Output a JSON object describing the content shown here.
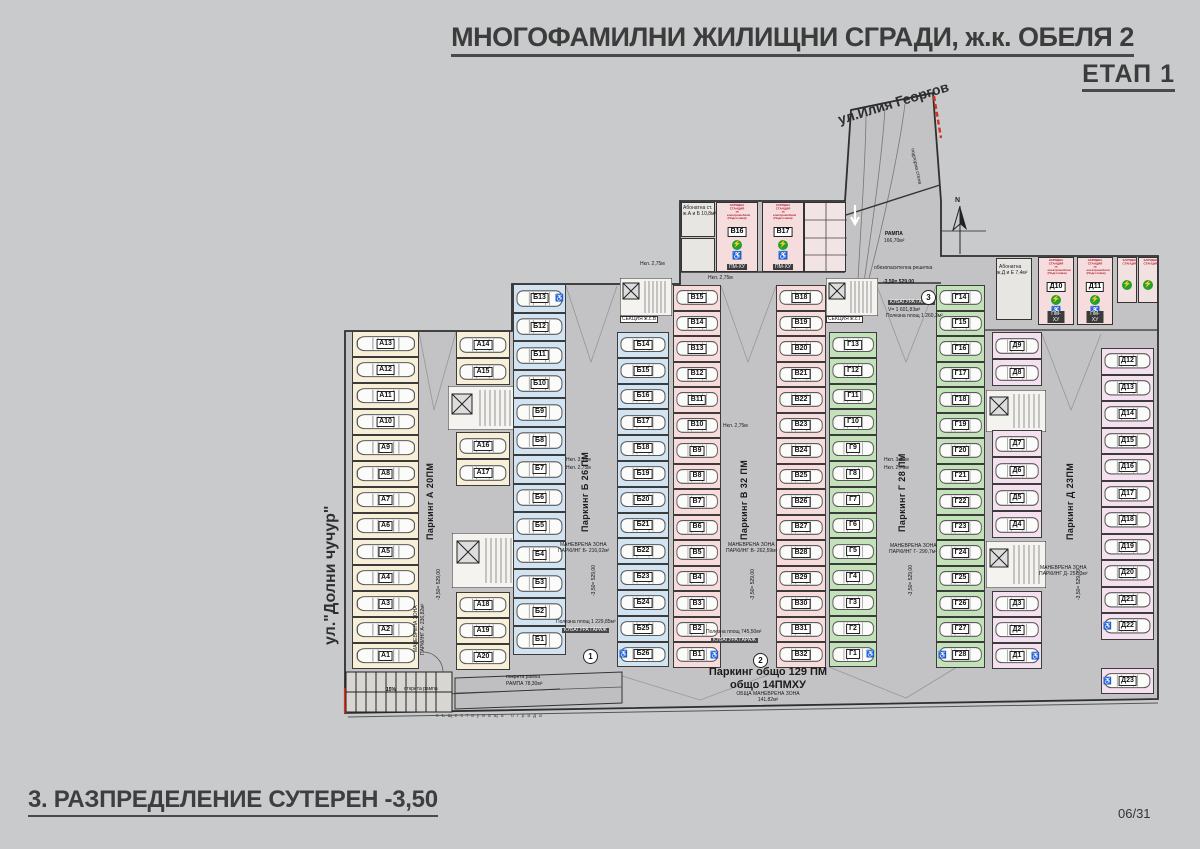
{
  "header": {
    "title": "МНОГОФАМИЛНИ ЖИЛИЩНИ СГРАДИ, ж.к. ОБЕЛЯ 2",
    "stage": "ЕТАП 1"
  },
  "footer": {
    "drawing_title": "3. РАЗПРЕДЕЛЕНИЕ СУТЕРЕН -3,50",
    "sheet": "06/31"
  },
  "streets": {
    "left": "ул.\"Долни чучур\"",
    "top_right": "ул.Илия Георгов"
  },
  "plan": {
    "north": "N",
    "totals": {
      "l1": "Паркинг общо 129 ПМ",
      "l2": "общо 14ПМХУ",
      "l3": "ОБЩА МАНЕВРЕНА ЗОНА",
      "l4": "141,82м²"
    },
    "sections": [
      {
        "id": "А",
        "color": "#f7efd8"
      },
      {
        "id": "Б",
        "color": "#d2e3f1"
      },
      {
        "id": "В",
        "color": "#f8dcdc"
      },
      {
        "id": "Г",
        "color": "#c4e2ba"
      },
      {
        "id": "Д",
        "color": "#f4e0ee"
      }
    ],
    "accessible": [
      "Б13",
      "Б26",
      "В1",
      "Г1",
      "Г28",
      "Д1",
      "Д22",
      "Д23"
    ],
    "columns": [
      {
        "sec": 0,
        "side": "L",
        "x": 352,
        "y": 331,
        "w": 67,
        "h": 26,
        "ids": [
          "А13",
          "А12",
          "А11",
          "А10",
          "А9",
          "А8",
          "А7",
          "А6",
          "А5",
          "А4",
          "А3",
          "А2",
          "А1"
        ]
      },
      {
        "sec": 0,
        "side": "L",
        "x": 456,
        "y": 331,
        "w": 54,
        "h": 27,
        "ids": [
          "А14",
          "А15"
        ]
      },
      {
        "sec": 0,
        "side": "L",
        "x": 456,
        "y": 432,
        "w": 54,
        "h": 27,
        "ids": [
          "А16",
          "А17"
        ]
      },
      {
        "sec": 0,
        "side": "L",
        "x": 456,
        "y": 592,
        "w": 54,
        "h": 26,
        "ids": [
          "А18",
          "А19",
          "А20"
        ]
      },
      {
        "sec": 1,
        "side": "L",
        "x": 513,
        "y": 284,
        "w": 53,
        "h": 28.5,
        "ids": [
          "Б13",
          "Б12",
          "Б11",
          "Б10",
          "Б9",
          "Б8",
          "Б7",
          "Б6",
          "Б5",
          "Б4",
          "Б3",
          "Б2",
          "Б1"
        ]
      },
      {
        "sec": 1,
        "side": "R",
        "x": 617,
        "y": 332,
        "w": 52,
        "h": 25.8,
        "ids": [
          "Б14",
          "Б15",
          "Б16",
          "Б17",
          "Б18",
          "Б19",
          "Б20",
          "Б21",
          "Б22",
          "Б23",
          "Б24",
          "Б25",
          "Б26"
        ]
      },
      {
        "sec": 2,
        "side": "L",
        "x": 673,
        "y": 285,
        "w": 48,
        "h": 25.5,
        "ids": [
          "В15",
          "В14",
          "В13",
          "В12",
          "В11",
          "В10",
          "В9",
          "В8",
          "В7",
          "В6",
          "В5",
          "В4",
          "В3",
          "В2",
          "В1"
        ]
      },
      {
        "sec": 2,
        "side": "R",
        "x": 776,
        "y": 285,
        "w": 50,
        "h": 25.5,
        "ids": [
          "В18",
          "В19",
          "В20",
          "В21",
          "В22",
          "В23",
          "В24",
          "В25",
          "В26",
          "В27",
          "В28",
          "В29",
          "В30",
          "В31",
          "В32"
        ]
      },
      {
        "sec": 3,
        "side": "L",
        "x": 829,
        "y": 332,
        "w": 48,
        "h": 25.8,
        "ids": [
          "Г13",
          "Г12",
          "Г11",
          "Г10",
          "Г9",
          "Г8",
          "Г7",
          "Г6",
          "Г5",
          "Г4",
          "Г3",
          "Г2",
          "Г1"
        ]
      },
      {
        "sec": 3,
        "side": "R",
        "x": 936,
        "y": 285,
        "w": 49,
        "h": 25.5,
        "ids": [
          "Г14",
          "Г15",
          "Г16",
          "Г17",
          "Г18",
          "Г19",
          "Г20",
          "Г21",
          "Г22",
          "Г23",
          "Г24",
          "Г25",
          "Г26",
          "Г27",
          "Г28"
        ]
      },
      {
        "sec": 4,
        "side": "L",
        "x": 992,
        "y": 332,
        "w": 50,
        "h": 27,
        "ids": [
          "Д9",
          "Д8"
        ]
      },
      {
        "sec": 4,
        "side": "L",
        "x": 992,
        "y": 430,
        "w": 50,
        "h": 27,
        "ids": [
          "Д7",
          "Д6",
          "Д5",
          "Д4"
        ]
      },
      {
        "sec": 4,
        "side": "L",
        "x": 992,
        "y": 591,
        "w": 50,
        "h": 26,
        "ids": [
          "Д3",
          "Д2",
          "Д1"
        ]
      },
      {
        "sec": 4,
        "side": "R",
        "x": 1101,
        "y": 348,
        "w": 53,
        "h": 26.5,
        "ids": [
          "Д12",
          "Д13",
          "Д14",
          "Д15",
          "Д16",
          "Д17",
          "Д18",
          "Д19",
          "Д20",
          "Д21",
          "Д22"
        ]
      },
      {
        "sec": 4,
        "side": "R",
        "x": 1101,
        "y": 668,
        "w": 53,
        "h": 26,
        "ids": [
          "Д23"
        ]
      }
    ],
    "charge_caption": [
      "ЗАРЯДНА СТАНЦИЯ",
      "за електромобили",
      "(Подготовка)"
    ],
    "charge_tag": "ПМ-ХУ",
    "charging": [
      {
        "id": "В16",
        "x": 716,
        "y": 202,
        "w": 42,
        "h": 70
      },
      {
        "id": "В17",
        "x": 762,
        "y": 202,
        "w": 42,
        "h": 70
      },
      {
        "id": "Д10",
        "x": 1038,
        "y": 257,
        "w": 36,
        "h": 68
      },
      {
        "id": "Д11",
        "x": 1077,
        "y": 257,
        "w": 36,
        "h": 68
      }
    ],
    "tech_caption": "ЗАРЯДНА СТАНЦИЯ",
    "tech_rooms": [
      {
        "x": 1117,
        "y": 257,
        "w": 20,
        "h": 46
      },
      {
        "x": 1138,
        "y": 257,
        "w": 20,
        "h": 46
      }
    ],
    "circles": [
      {
        "n": "1",
        "x": 583,
        "y": 649
      },
      {
        "n": "2",
        "x": 753,
        "y": 653
      },
      {
        "n": "3",
        "x": 921,
        "y": 290
      }
    ],
    "labels": [
      {
        "t": "Паркинг А 20ПМ",
        "x": 426,
        "y": 540,
        "cls": "al",
        "rot": -90
      },
      {
        "t": "Паркинг Б 26 ПМ",
        "x": 581,
        "y": 532,
        "cls": "al",
        "rot": -90
      },
      {
        "t": "Паркинг В 32 ПМ",
        "x": 740,
        "y": 540,
        "cls": "al",
        "rot": -90
      },
      {
        "t": "Паркинг Г 28 ПМ",
        "x": 898,
        "y": 532,
        "cls": "al",
        "rot": -90
      },
      {
        "t": "Паркинг Д 23ПМ",
        "x": 1066,
        "y": 540,
        "cls": "al",
        "rot": -90
      },
      {
        "t": "-3,50= 529,00",
        "x": 437,
        "y": 600,
        "cls": "lv",
        "rot": -90
      },
      {
        "t": "-3,50= 529,00",
        "x": 592,
        "y": 596,
        "cls": "lv",
        "rot": -90
      },
      {
        "t": "-3,50= 529,00",
        "x": 751,
        "y": 600,
        "cls": "lv",
        "rot": -90
      },
      {
        "t": "-3,50= 529,00",
        "x": 909,
        "y": 596,
        "cls": "lv",
        "rot": -90
      },
      {
        "t": "-3,50= 529,00",
        "x": 1077,
        "y": 600,
        "cls": "lv",
        "rot": -90
      },
      {
        "t": "МАНЕВРЕНА ЗОНА",
        "x": 414,
        "y": 652,
        "cls": "d",
        "rot": -90
      },
      {
        "t": "ПАРКИНГ А- 236,82м²",
        "x": 421,
        "y": 655,
        "cls": "d",
        "rot": -90
      },
      {
        "t": "МАНЕВРЕНА ЗОНА",
        "x": 560,
        "y": 543,
        "cls": "d"
      },
      {
        "t": "ПАРКИНГ Б- 216,02м²",
        "x": 558,
        "y": 549,
        "cls": "d"
      },
      {
        "t": "МАНЕВРЕНА ЗОНА",
        "x": 728,
        "y": 543,
        "cls": "d"
      },
      {
        "t": "ПАРКИНГ В- 262,59м²",
        "x": 726,
        "y": 549,
        "cls": "d"
      },
      {
        "t": "МАНЕВРЕНА ЗОНА",
        "x": 890,
        "y": 544,
        "cls": "d"
      },
      {
        "t": "ПАРКИНГ Г- 290,7м²",
        "x": 889,
        "y": 550,
        "cls": "d"
      },
      {
        "t": "МАНЕВРЕНА ЗОНА",
        "x": 1040,
        "y": 566,
        "cls": "d"
      },
      {
        "t": "ПАРКИНГ Д- 257,3м²",
        "x": 1039,
        "y": 572,
        "cls": "d"
      },
      {
        "t": "Нкл. 3,10м",
        "x": 566,
        "y": 458,
        "cls": "d"
      },
      {
        "t": "Нкл. 2,75м",
        "x": 566,
        "y": 466,
        "cls": "d"
      },
      {
        "t": "Нкл. 2,75м",
        "x": 723,
        "y": 424,
        "cls": "d"
      },
      {
        "t": "Нкл. 3,10м",
        "x": 884,
        "y": 458,
        "cls": "d"
      },
      {
        "t": "Нкл. 2,75м",
        "x": 884,
        "y": 466,
        "cls": "d"
      },
      {
        "t": "Нкл. 2,75м",
        "x": 640,
        "y": 262,
        "cls": "d"
      },
      {
        "t": "Нкл. 2,75м",
        "x": 708,
        "y": 276,
        "cls": "d"
      },
      {
        "t": "РАМПА",
        "x": 885,
        "y": 232,
        "cls": "db"
      },
      {
        "t": "166,70м²",
        "x": 884,
        "y": 239,
        "cls": "d"
      },
      {
        "t": "подпорна стена",
        "x": 914,
        "y": 148,
        "cls": "d",
        "rot": 78
      },
      {
        "t": "обезопасителна решетка",
        "x": 874,
        "y": 266,
        "cls": "d"
      },
      {
        "t": "15%",
        "x": 386,
        "y": 688,
        "cls": "db"
      },
      {
        "t": "открита рампа",
        "x": 404,
        "y": 687,
        "cls": "d"
      },
      {
        "t": "покрита рампа",
        "x": 506,
        "y": 675,
        "cls": "d"
      },
      {
        "t": "РАМПА 78,30м²",
        "x": 506,
        "y": 682,
        "cls": "d"
      },
      {
        "t": "съществуваща ограда",
        "x": 436,
        "y": 714,
        "cls": "fence"
      },
      {
        "t": "СЕКЦИЯ ж.с.В",
        "x": 620,
        "y": 316,
        "cls": "sec"
      },
      {
        "t": "СЕКЦИЯ ж.с.Г",
        "x": 826,
        "y": 316,
        "cls": "sec"
      },
      {
        "t": "Абонатна ст.",
        "x": 683,
        "y": 206,
        "cls": "d"
      },
      {
        "t": "ж.А и Б 10,8м²",
        "x": 683,
        "y": 212,
        "cls": "d"
      },
      {
        "t": "Абонатна",
        "x": 999,
        "y": 265,
        "cls": "d"
      },
      {
        "t": "ж.Д и Е 7,4м²",
        "x": 997,
        "y": 271,
        "cls": "d"
      },
      {
        "t": "Полезна площ 1 229,85м²",
        "x": 556,
        "y": 620,
        "cls": "d"
      },
      {
        "t": "КУБАТУРА ГАРАЖ",
        "x": 562,
        "y": 628,
        "cls": "kb"
      },
      {
        "t": "Полезна площ 745,50м²",
        "x": 706,
        "y": 630,
        "cls": "d"
      },
      {
        "t": "КУБАТУРА ГАРАЖ",
        "x": 711,
        "y": 638,
        "cls": "kb"
      },
      {
        "t": "-3,50= 529,00",
        "x": 883,
        "y": 280,
        "cls": "db"
      },
      {
        "t": "КУБАТУРА ГАРАЖ",
        "x": 888,
        "y": 300,
        "cls": "kb"
      },
      {
        "t": "V= 1 601,83м³",
        "x": 888,
        "y": 308,
        "cls": "d"
      },
      {
        "t": "Полезна площ 1 260,3м²",
        "x": 886,
        "y": 314,
        "cls": "d"
      }
    ]
  }
}
